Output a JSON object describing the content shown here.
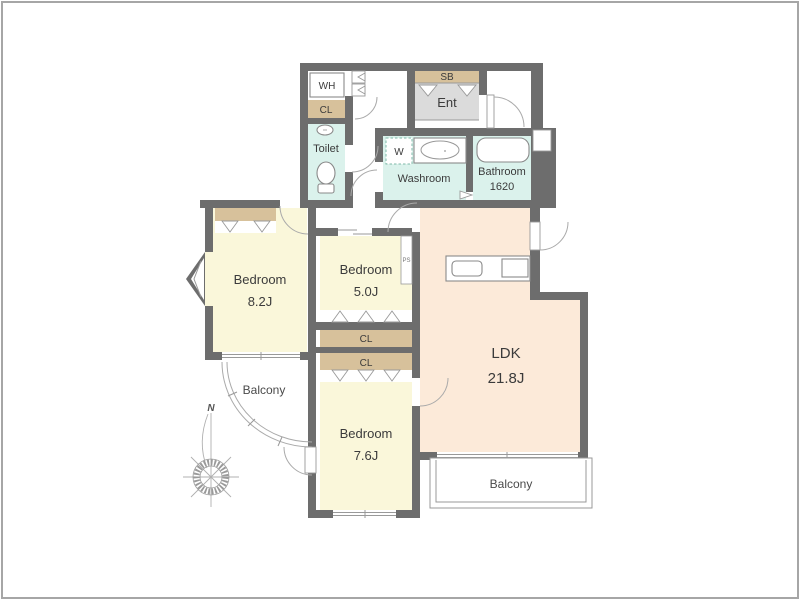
{
  "rooms": {
    "wh": "WH",
    "cl_hall": "CL",
    "toilet": "Toilet",
    "sb": "SB",
    "entrance": "Ent",
    "washer": "W",
    "washroom": "Washroom",
    "bathroom": {
      "name": "Bathroom",
      "size": "1620"
    },
    "bedroom_82": {
      "name": "Bedroom",
      "size": "8.2J"
    },
    "bedroom_50": {
      "name": "Bedroom",
      "size": "5.0J"
    },
    "bedroom_76": {
      "name": "Bedroom",
      "size": "7.6J"
    },
    "ldk": {
      "name": "LDK",
      "size": "21.8J"
    },
    "closet_bedroom_82": "CL",
    "closet_bedroom_50": "CL",
    "closet_bedroom_76": "CL",
    "pipe_space": "PS",
    "balcony_west": "Balcony",
    "balcony_south": "Balcony"
  },
  "compass": {
    "north": "N"
  },
  "colors": {
    "wall": "#6d6d6d",
    "bedroom_fill": "#faf7da",
    "ldk_fill": "#fcead9",
    "wet_area_fill": "#dbf2ec",
    "closet_fill": "#d7c19b",
    "entrance_fill": "#dbdbdb",
    "outline": "#999999",
    "text": "#3b3b3b",
    "frame": "#a6a6a6"
  }
}
